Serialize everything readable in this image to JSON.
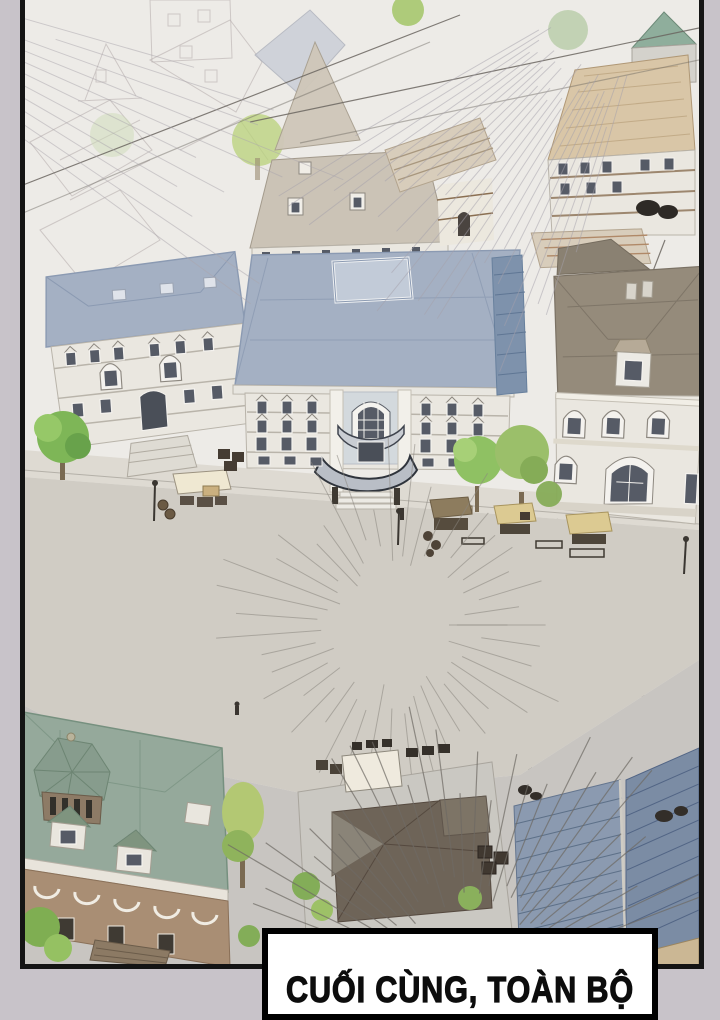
{
  "page": {
    "background_color": "#c8c3c9"
  },
  "panel": {
    "paper_color": "#edebe7",
    "border_color": "#141414"
  },
  "caption": {
    "text": "CUỐI CÙNG, TOÀN BỘ",
    "text_color": "#0d0d0d",
    "background_color": "#ffffff",
    "border_color": "#000000"
  },
  "palette": {
    "roof_blue": "#a4b0c3",
    "roof_blue_dark": "#8b9ab2",
    "roof_taupe": "#958b7b",
    "roof_green": "#95a99b",
    "roof_slate_left": "#8b9ab0",
    "roof_slate_right": "#7b8ca4",
    "roof_dark": "#6e6458",
    "facade_cream": "#eae7e0",
    "facade_trim": "#b9b4aa",
    "window_dark": "#565b66",
    "street": "#dedad2",
    "plaza": "#d0ccc4",
    "cobble": "#c8c5c1",
    "tree_green": "#7eb657",
    "tree_light": "#b3c873",
    "awning_cream": "#efe8d2",
    "awning_tan": "#dcca92",
    "awning_brown": "#8d7c5e",
    "brick_tan": "#d9c6a7",
    "brick_brown": "#a98e74",
    "ink": "#3a3631",
    "speedline": "#8a867f",
    "cable": "#6b6660"
  },
  "scene": {
    "objects": [
      "aerial town square",
      "central hall with blue hip roof and skylight",
      "left townhouse with blue roof and stairs",
      "right building with taupe roof and arched windows",
      "market stalls with awnings",
      "street lamps and crates",
      "green-roof manor with octagonal cupola",
      "dark cross-gable roof house",
      "blue slatted roof building",
      "trees",
      "power lines",
      "manga speed lines"
    ]
  }
}
